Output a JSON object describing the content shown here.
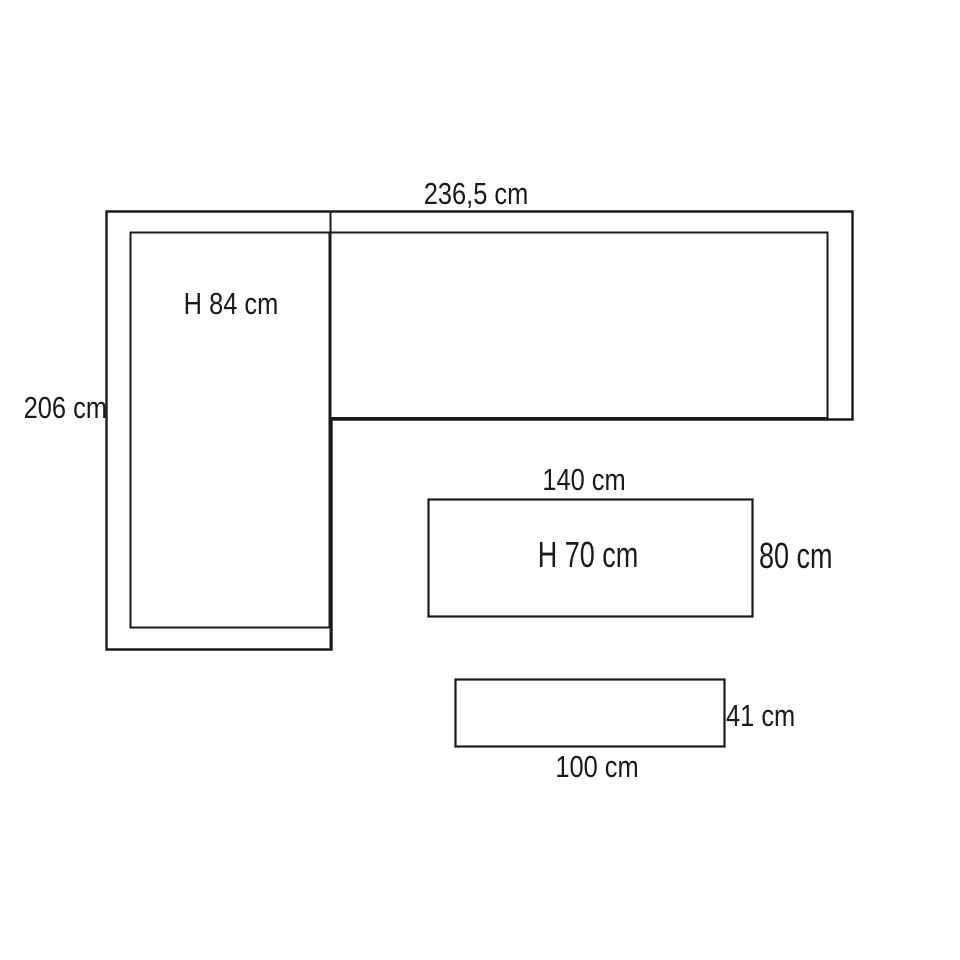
{
  "diagram": {
    "kind": "furniture-dimension-drawing",
    "background_color": "#ffffff",
    "line_color": "#1a1a1a",
    "labels": {
      "overall_width": "236,5 cm",
      "overall_depth": "206 cm",
      "sofa_height": "H 84 cm",
      "bench_width": "140 cm",
      "bench_height": "H 70 cm",
      "bench_depth": "80 cm",
      "table_height": "41 cm",
      "table_width": "100 cm"
    }
  }
}
